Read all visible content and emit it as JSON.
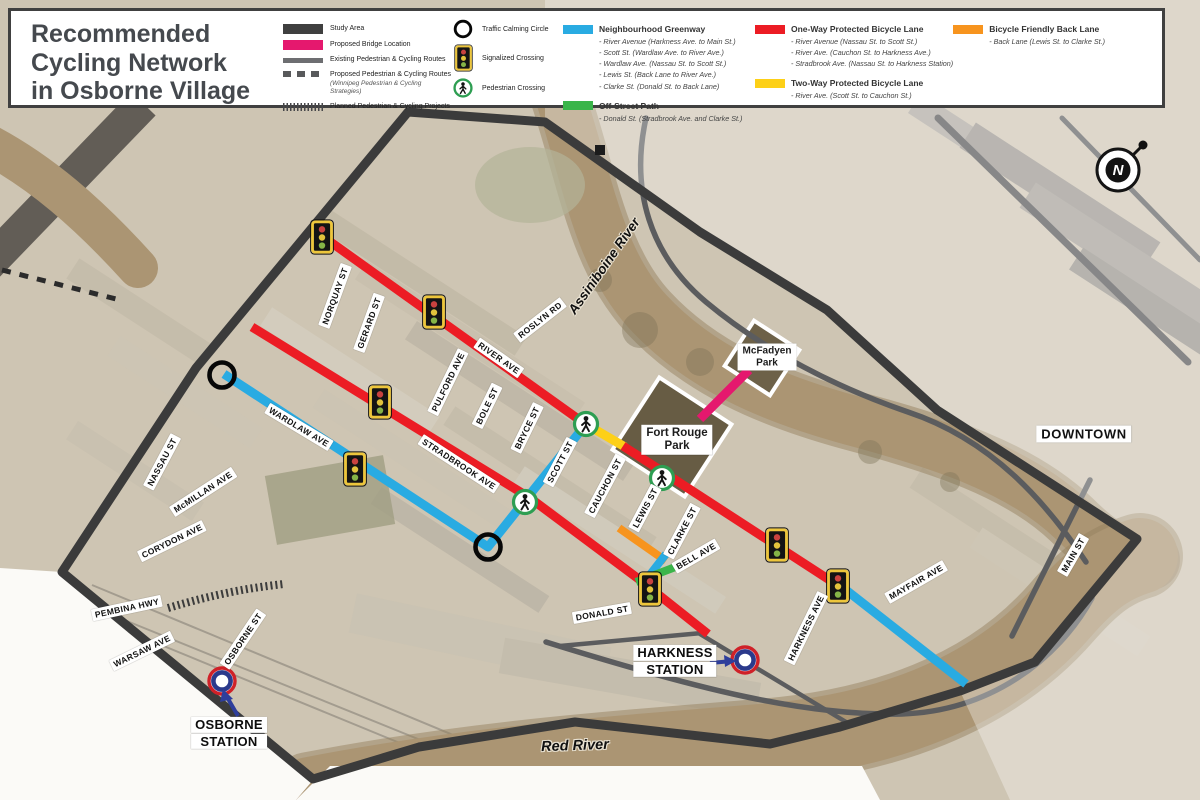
{
  "title": {
    "lines": [
      "Recommended",
      "Cycling Network",
      "in Osborne Village"
    ]
  },
  "legend": {
    "area_items": [
      {
        "label": "Study Area"
      },
      {
        "label": "Proposed Bridge Location"
      },
      {
        "label": "Existing Pedestrian & Cycling Routes"
      },
      {
        "label": "Proposed Pedestrian & Cycling Routes",
        "note": "(Winnipeg Pedestrian & Cycling Strategies)"
      },
      {
        "label": "Planned Pedestrian & Cycling Projects"
      }
    ],
    "point_items": [
      {
        "label": "Traffic Calming Circle"
      },
      {
        "label": "Signalized Crossing"
      },
      {
        "label": "Pedestrian Crossing"
      }
    ],
    "route_groups": [
      {
        "title": "Neighbourhood Greenway",
        "color": "greenway",
        "items": [
          "River Avenue (Harkness Ave. to Main St.)",
          "Scott St. (Wardlaw Ave. to River Ave.)",
          "Wardlaw Ave. (Nassau St. to Scott St.)",
          "Lewis St. (Back Lane to River Ave.)",
          "Clarke St. (Donald St. to Back Lane)"
        ]
      },
      {
        "title": "Off-Street Path",
        "color": "path",
        "items": [
          "Donald St. (Stradbrook Ave. and Clarke St.)"
        ]
      },
      {
        "title": "One-Way Protected Bicycle Lane",
        "color": "oneway",
        "items": [
          "River Avenue (Nassau St. to Scott St.)",
          "River Ave. (Cauchon St. to Harkness Ave.)",
          "Stradbrook Ave. (Nassau St. to Harkness Station)"
        ]
      },
      {
        "title": "Two-Way Protected Bicycle Lane",
        "color": "twoway",
        "items": [
          "River Ave. (Scott St. to Cauchon St.)"
        ]
      },
      {
        "title": "Bicycle Friendly Back Lane",
        "color": "backlane",
        "items": [
          "Back Lane (Lewis St. to Clarke St.)"
        ]
      }
    ]
  },
  "colors": {
    "greenway": "#29abe2",
    "path": "#3ab54a",
    "oneway": "#ec1c24",
    "twoway": "#fdd017",
    "backlane": "#f7941e",
    "bridge": "#e5186e",
    "study_area": "#3f3f3f",
    "existing_route": "#6d6e71",
    "proposed_route": "#58595b",
    "planned_route": "#47474a",
    "station_outer": "#cf2128",
    "station_inner": "#2b3a8c",
    "arrow": "#2e3e9b",
    "signal_frame": "#edc63c",
    "ped_ring": "#2e9e52"
  },
  "map": {
    "street_labels": [
      {
        "t": "NORQUAY ST",
        "x": 335,
        "y": 296,
        "r": -70
      },
      {
        "t": "GERARD ST",
        "x": 369,
        "y": 323,
        "r": -70
      },
      {
        "t": "ROSLYN RD",
        "x": 540,
        "y": 320,
        "r": -38
      },
      {
        "t": "RIVER AVE",
        "x": 499,
        "y": 358,
        "r": 35
      },
      {
        "t": "PULFORD AVE",
        "x": 448,
        "y": 382,
        "r": -64
      },
      {
        "t": "BOLE ST",
        "x": 487,
        "y": 406,
        "r": -64
      },
      {
        "t": "BRYCE ST",
        "x": 527,
        "y": 428,
        "r": -64
      },
      {
        "t": "WARDLAW AVE",
        "x": 299,
        "y": 427,
        "r": 31
      },
      {
        "t": "NASSAU ST",
        "x": 162,
        "y": 462,
        "r": -62
      },
      {
        "t": "McMILLAN AVE",
        "x": 203,
        "y": 492,
        "r": -33
      },
      {
        "t": "CORYDON AVE",
        "x": 172,
        "y": 541,
        "r": -26
      },
      {
        "t": "SCOTT ST",
        "x": 560,
        "y": 462,
        "r": -62
      },
      {
        "t": "STRADBROOK AVE",
        "x": 459,
        "y": 464,
        "r": 33
      },
      {
        "t": "CAUCHON ST",
        "x": 605,
        "y": 486,
        "r": -62
      },
      {
        "t": "LEWIS ST",
        "x": 645,
        "y": 508,
        "r": -62
      },
      {
        "t": "CLARKE ST",
        "x": 682,
        "y": 531,
        "r": -62
      },
      {
        "t": "BELL AVE",
        "x": 696,
        "y": 556,
        "r": -30
      },
      {
        "t": "PEMBINA HWY",
        "x": 127,
        "y": 608,
        "r": -12
      },
      {
        "t": "WARSAW AVE",
        "x": 142,
        "y": 651,
        "r": -26
      },
      {
        "t": "OSBORNE ST",
        "x": 243,
        "y": 639,
        "r": -56
      },
      {
        "t": "DONALD ST",
        "x": 602,
        "y": 613,
        "r": -10
      },
      {
        "t": "HARKNESS AVE",
        "x": 806,
        "y": 628,
        "r": -64
      },
      {
        "t": "MAYFAIR AVE",
        "x": 916,
        "y": 582,
        "r": -30
      },
      {
        "t": "MAIN ST",
        "x": 1073,
        "y": 555,
        "r": -60
      }
    ],
    "places": {
      "assiniboine": "Assiniboine River",
      "red_river": "Red River",
      "downtown": "DOWNTOWN",
      "fort_rouge": {
        "lines": [
          "Fort Rouge",
          "Park"
        ]
      },
      "mcfadyen": {
        "lines": [
          "McFadyen",
          "Park"
        ]
      },
      "osborne_station": {
        "lines": [
          "OSBORNE",
          "STATION"
        ]
      },
      "harkness_station": {
        "lines": [
          "HARKNESS",
          "STATION"
        ]
      }
    }
  },
  "compass": {
    "letter": "N"
  }
}
